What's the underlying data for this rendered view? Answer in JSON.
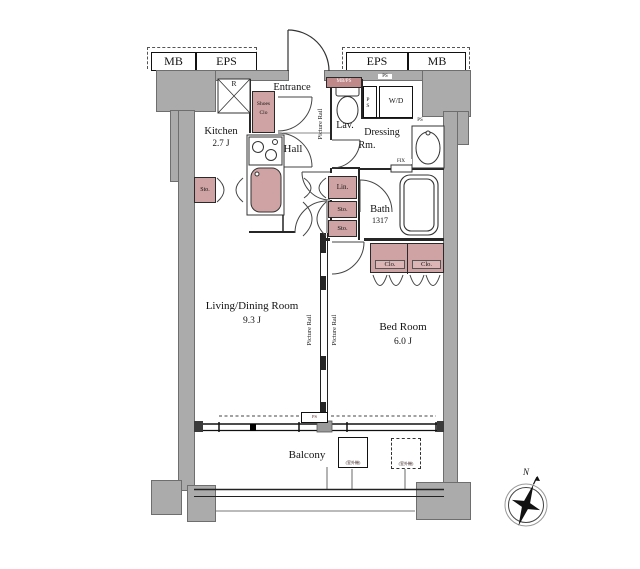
{
  "colors": {
    "wall_gray": "#ababab",
    "fixture_pink": "#cfa3a3",
    "line": "#222222",
    "background": "#ffffff"
  },
  "utility_boxes": {
    "mb": "MB",
    "eps": "EPS"
  },
  "rooms": {
    "entrance": "Entrance",
    "kitchen": {
      "name": "Kitchen",
      "size": "2.7 J"
    },
    "hall": "Hall",
    "lavatory": "Lav.",
    "dressing": {
      "line1": "Dressing",
      "line2": "Rm."
    },
    "bath": {
      "name": "Bath",
      "size": "1317"
    },
    "living": {
      "name": "Living/Dining Room",
      "size": "9.3 J"
    },
    "bedroom": {
      "name": "Bed Room",
      "size": "6.0 J"
    },
    "balcony": "Balcony"
  },
  "fixtures": {
    "refrigerator": "R",
    "washer_dryer": "W/D",
    "shoes_closet": {
      "line1": "Shoes",
      "line2": "Clo"
    },
    "storage": "Sto.",
    "linen": "Lin.",
    "closet": "Clo.",
    "pipe_space": "PS",
    "meter_pipe_space": "MB/PS",
    "fixed_window": "FIX",
    "picture_rail": "Picture Rail",
    "ac_outdoor_unit": "(室外機)"
  },
  "compass": {
    "north": "N"
  }
}
